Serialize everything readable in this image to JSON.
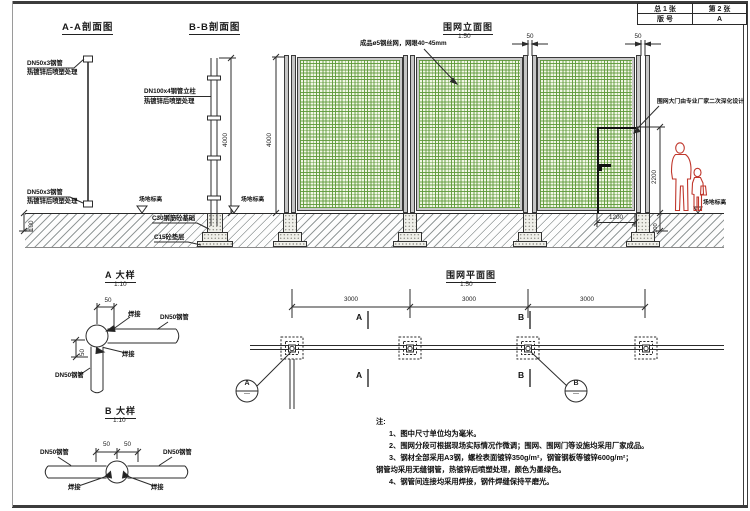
{
  "page": {
    "title_block": {
      "cell_total": "总 1 张",
      "cell_sheet": "第 2 张",
      "cell_rev_label": "版 号",
      "cell_rev_value": "A"
    }
  },
  "section_aa": {
    "title": "A-A剖面图",
    "rail_label_line1": "DN50x3钢管",
    "rail_label_line2": "热镀锌后喷塑处理",
    "bottom_label_line1": "DN50x3钢管",
    "bottom_label_line2": "热镀锌后喷塑处理",
    "dim_embed": "100"
  },
  "section_bb": {
    "title": "B-B剖面图",
    "post_label_line1": "DN100x4钢管立柱",
    "post_label_line2": "热镀锌后喷塑处理",
    "dim_height": "4000",
    "foundation_label": "C30钢筋砼基础",
    "cushion_label": "C15砼垫层",
    "ground_label_1": "场地标高",
    "ground_label_2": "场地标高"
  },
  "elevation": {
    "title": "围网立面图",
    "scale": "1:50",
    "mesh_label": "成品ø5钢丝网，网眼40~45mm",
    "gate_label": "围网大门由专业厂家二次深化设计",
    "dim_height": "4000",
    "dim_gap_1": "50",
    "dim_gap_2": "50",
    "dim_door_height": "2200",
    "dim_door_width": "1200",
    "dim_embed": "100",
    "ground_label": "场地标高"
  },
  "detail_a": {
    "title": "A 大样",
    "scale": "1:10",
    "dim_h": "50",
    "dim_v": "50",
    "weld_label_1": "焊接",
    "weld_label_2": "焊接",
    "pipe_label_h": "DN50钢管",
    "pipe_label_v": "DN50钢管"
  },
  "detail_b": {
    "title": "B 大样",
    "scale": "1:10",
    "dim_l": "50",
    "dim_r": "50",
    "pipe_label_l": "DN50钢管",
    "pipe_label_r": "DN50钢管",
    "weld_label_l": "焊接",
    "weld_label_r": "焊接"
  },
  "plan": {
    "title": "围网平面图",
    "scale": "1:50",
    "dim_1": "3000",
    "dim_2": "3000",
    "dim_3": "3000",
    "section_a_top": "A",
    "section_a_bottom": "A",
    "section_b_top": "B",
    "section_b_bottom": "B",
    "bubble_a_letter": "A",
    "bubble_a_sheet": "—",
    "bubble_b_letter": "B",
    "bubble_b_sheet": "—"
  },
  "notes": {
    "heading": "注:",
    "line_1": "1、图中尺寸单位均为毫米。",
    "line_2": "2、围网分段可根据现场实际情况作微调；围网、围网门等设施均采用厂家成品。",
    "line_3": "3、钢材全部采用A3钢，螺栓表面镀锌350g/m²，钢管钢板等镀锌600g/m²；",
    "line_3b": "钢管均采用无缝钢管，热镀锌后喷塑处理，颜色为墨绿色。",
    "line_4": "4、钢管间连接均采用焊接，钢件焊缝保持平磨光。"
  },
  "colors": {
    "mesh_green": "#5c9837",
    "mesh_bg": "#f1f6e4",
    "frame_gray": "#c6c6c6",
    "figure_red": "#c0372c",
    "line_black": "#2b2b2b"
  }
}
